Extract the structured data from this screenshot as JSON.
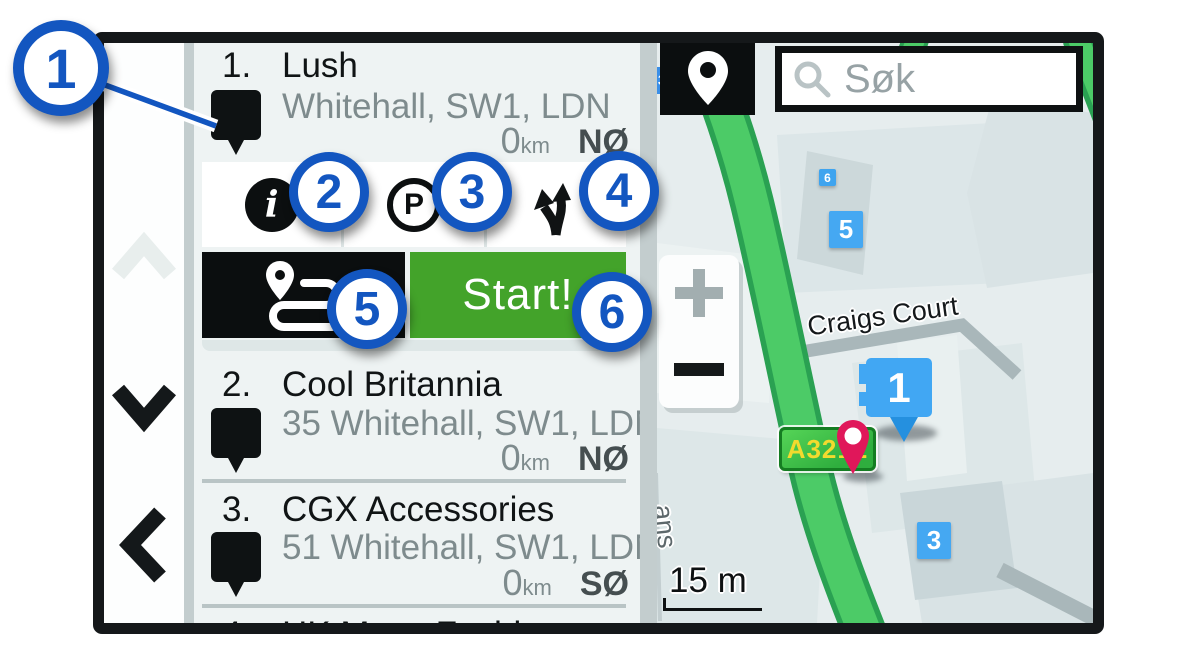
{
  "callouts": [
    "1",
    "2",
    "3",
    "4",
    "5",
    "6"
  ],
  "results": {
    "items": [
      {
        "index": "1.",
        "title": "Lush",
        "address": "Whitehall, SW1, LDN",
        "distance_value": "0",
        "distance_unit": "km",
        "direction": "NØ"
      },
      {
        "index": "2.",
        "title": "Cool Britannia",
        "address": "35 Whitehall, SW1, LDN",
        "distance_value": "0",
        "distance_unit": "km",
        "direction": "NØ"
      },
      {
        "index": "3.",
        "title": "CGX Accessories",
        "address": "51 Whitehall, SW1, LDN",
        "distance_value": "0",
        "distance_unit": "km",
        "direction": "SØ"
      },
      {
        "index": "4.",
        "title": "HK Mens Fashion"
      }
    ],
    "actions": {
      "info_icon": "information",
      "parking_label": "P",
      "fork_icon": "route-fork",
      "route_icon": "trip-route",
      "start_button": "Start!"
    }
  },
  "map": {
    "search_placeholder": "Søk",
    "pin_button_icon": "location-pin",
    "street_label": "Craigs Court",
    "street_label_partial": "ans",
    "road_shield_label": "A3212",
    "road_shield_small": "3",
    "building_badges": [
      "6",
      "5",
      "3"
    ],
    "selected_marker": "1",
    "zoom_in_icon": "plus",
    "zoom_out_icon": "minus",
    "scale_label": "15 m"
  },
  "colors": {
    "callout_blue": "#1356c0",
    "start_green": "#43a32a",
    "marker_blue": "#41a7f3",
    "shield_green": "#2fae3e",
    "pin_red": "#e0175a",
    "road_green": "#4ccb67"
  }
}
